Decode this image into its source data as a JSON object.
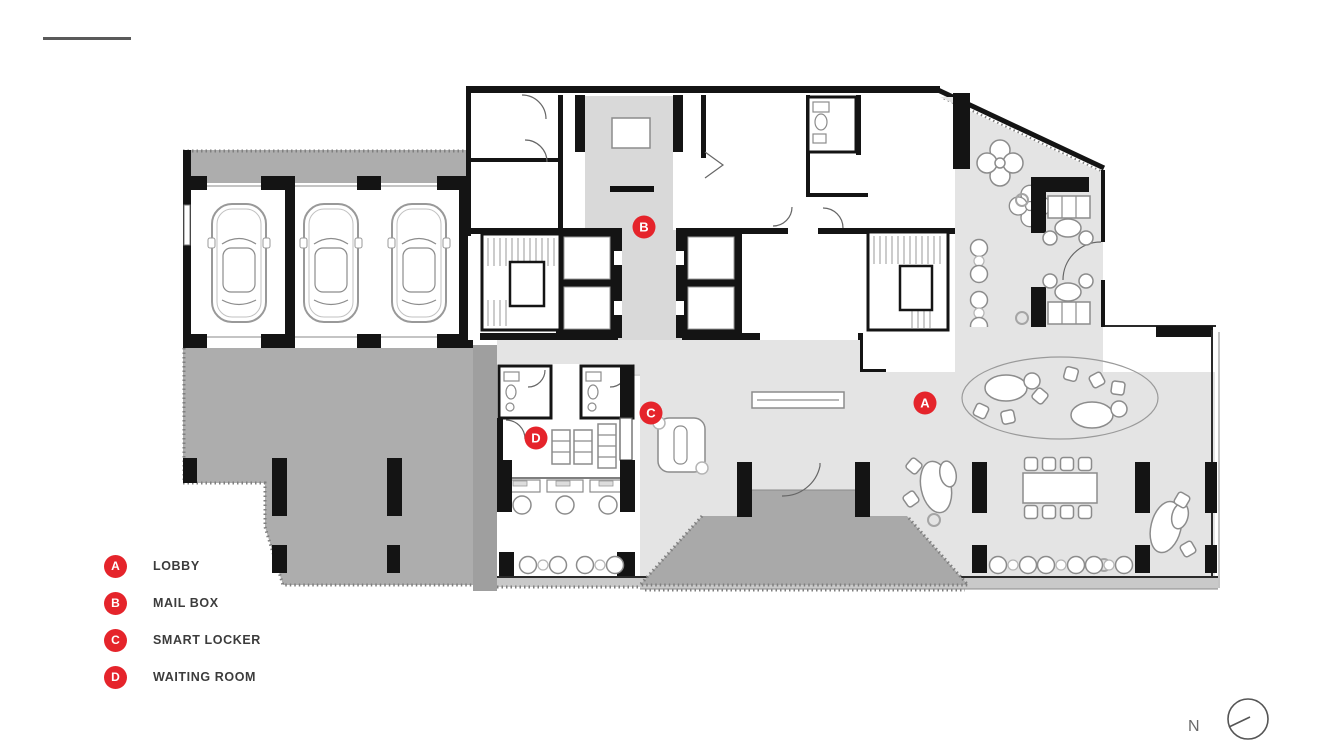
{
  "page": {
    "title_fragment": "1ST FLOOR PLAN",
    "corner_fragment": "LOBBY 1F"
  },
  "legend": {
    "items": [
      {
        "letter": "A",
        "label": "LOBBY"
      },
      {
        "letter": "B",
        "label": "MAIL BOX"
      },
      {
        "letter": "C",
        "label": "SMART LOCKER"
      },
      {
        "letter": "D",
        "label": "WAITING ROOM"
      }
    ]
  },
  "plan": {
    "markers": [
      {
        "letter": "A",
        "area": "lobby"
      },
      {
        "letter": "B",
        "area": "mail-box"
      },
      {
        "letter": "C",
        "area": "smart-locker"
      },
      {
        "letter": "D",
        "area": "waiting-room"
      }
    ]
  },
  "north_indicator": {
    "label": "N"
  },
  "colors": {
    "marker_red": "#e5242b",
    "floor_light": "#e4e4e4",
    "floor_corridor": "#d9d9d9",
    "floor_mid": "#adadad",
    "floor_dark": "#a9a9a9",
    "sill_band": "#c9c9c9",
    "wall_black": "#141414",
    "legend_text": "#3c3c3c"
  }
}
